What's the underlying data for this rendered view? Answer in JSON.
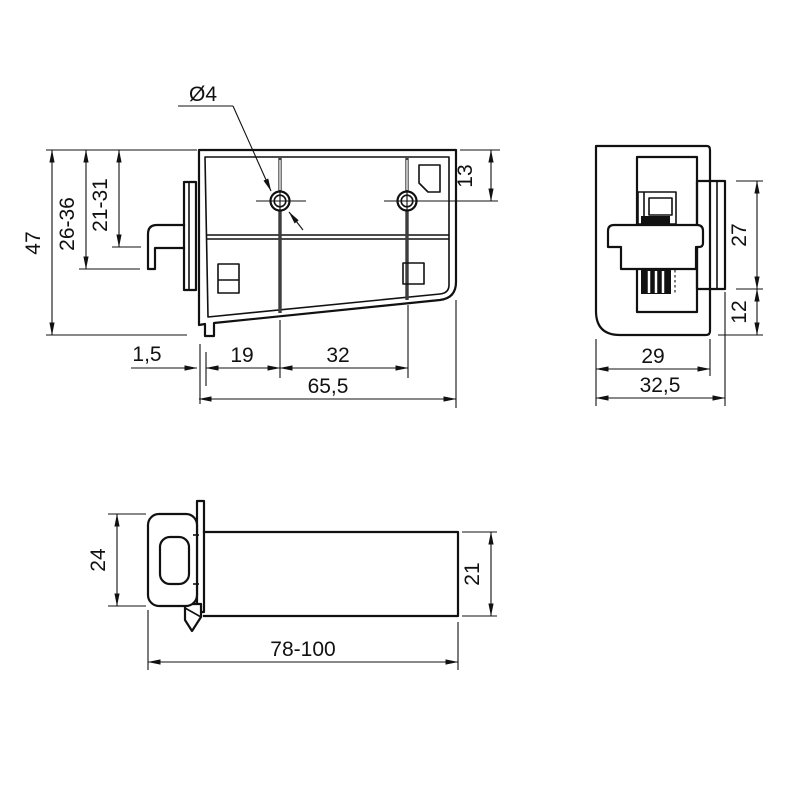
{
  "drawing": {
    "type": "technical-drawing",
    "background": "#ffffff",
    "line_color": "#111111",
    "views": {
      "front": {
        "name": "front-view",
        "dims": {
          "hole_diameter": "Ø4",
          "hole_top_offset": "13",
          "total_height": "47",
          "range_outer": "26-36",
          "range_inner": "21-31",
          "wall_thickness": "1,5",
          "hole_left_offset": "19",
          "hole_spacing": "32",
          "total_width": "65,5"
        }
      },
      "side": {
        "name": "side-view",
        "dims": {
          "flange_height": "27",
          "bottom_offset": "12",
          "body_width": "29",
          "total_width": "32,5"
        }
      },
      "bottom": {
        "name": "bottom-view",
        "dims": {
          "head_height": "24",
          "tube_height": "21",
          "total_length": "78-100"
        }
      }
    }
  }
}
